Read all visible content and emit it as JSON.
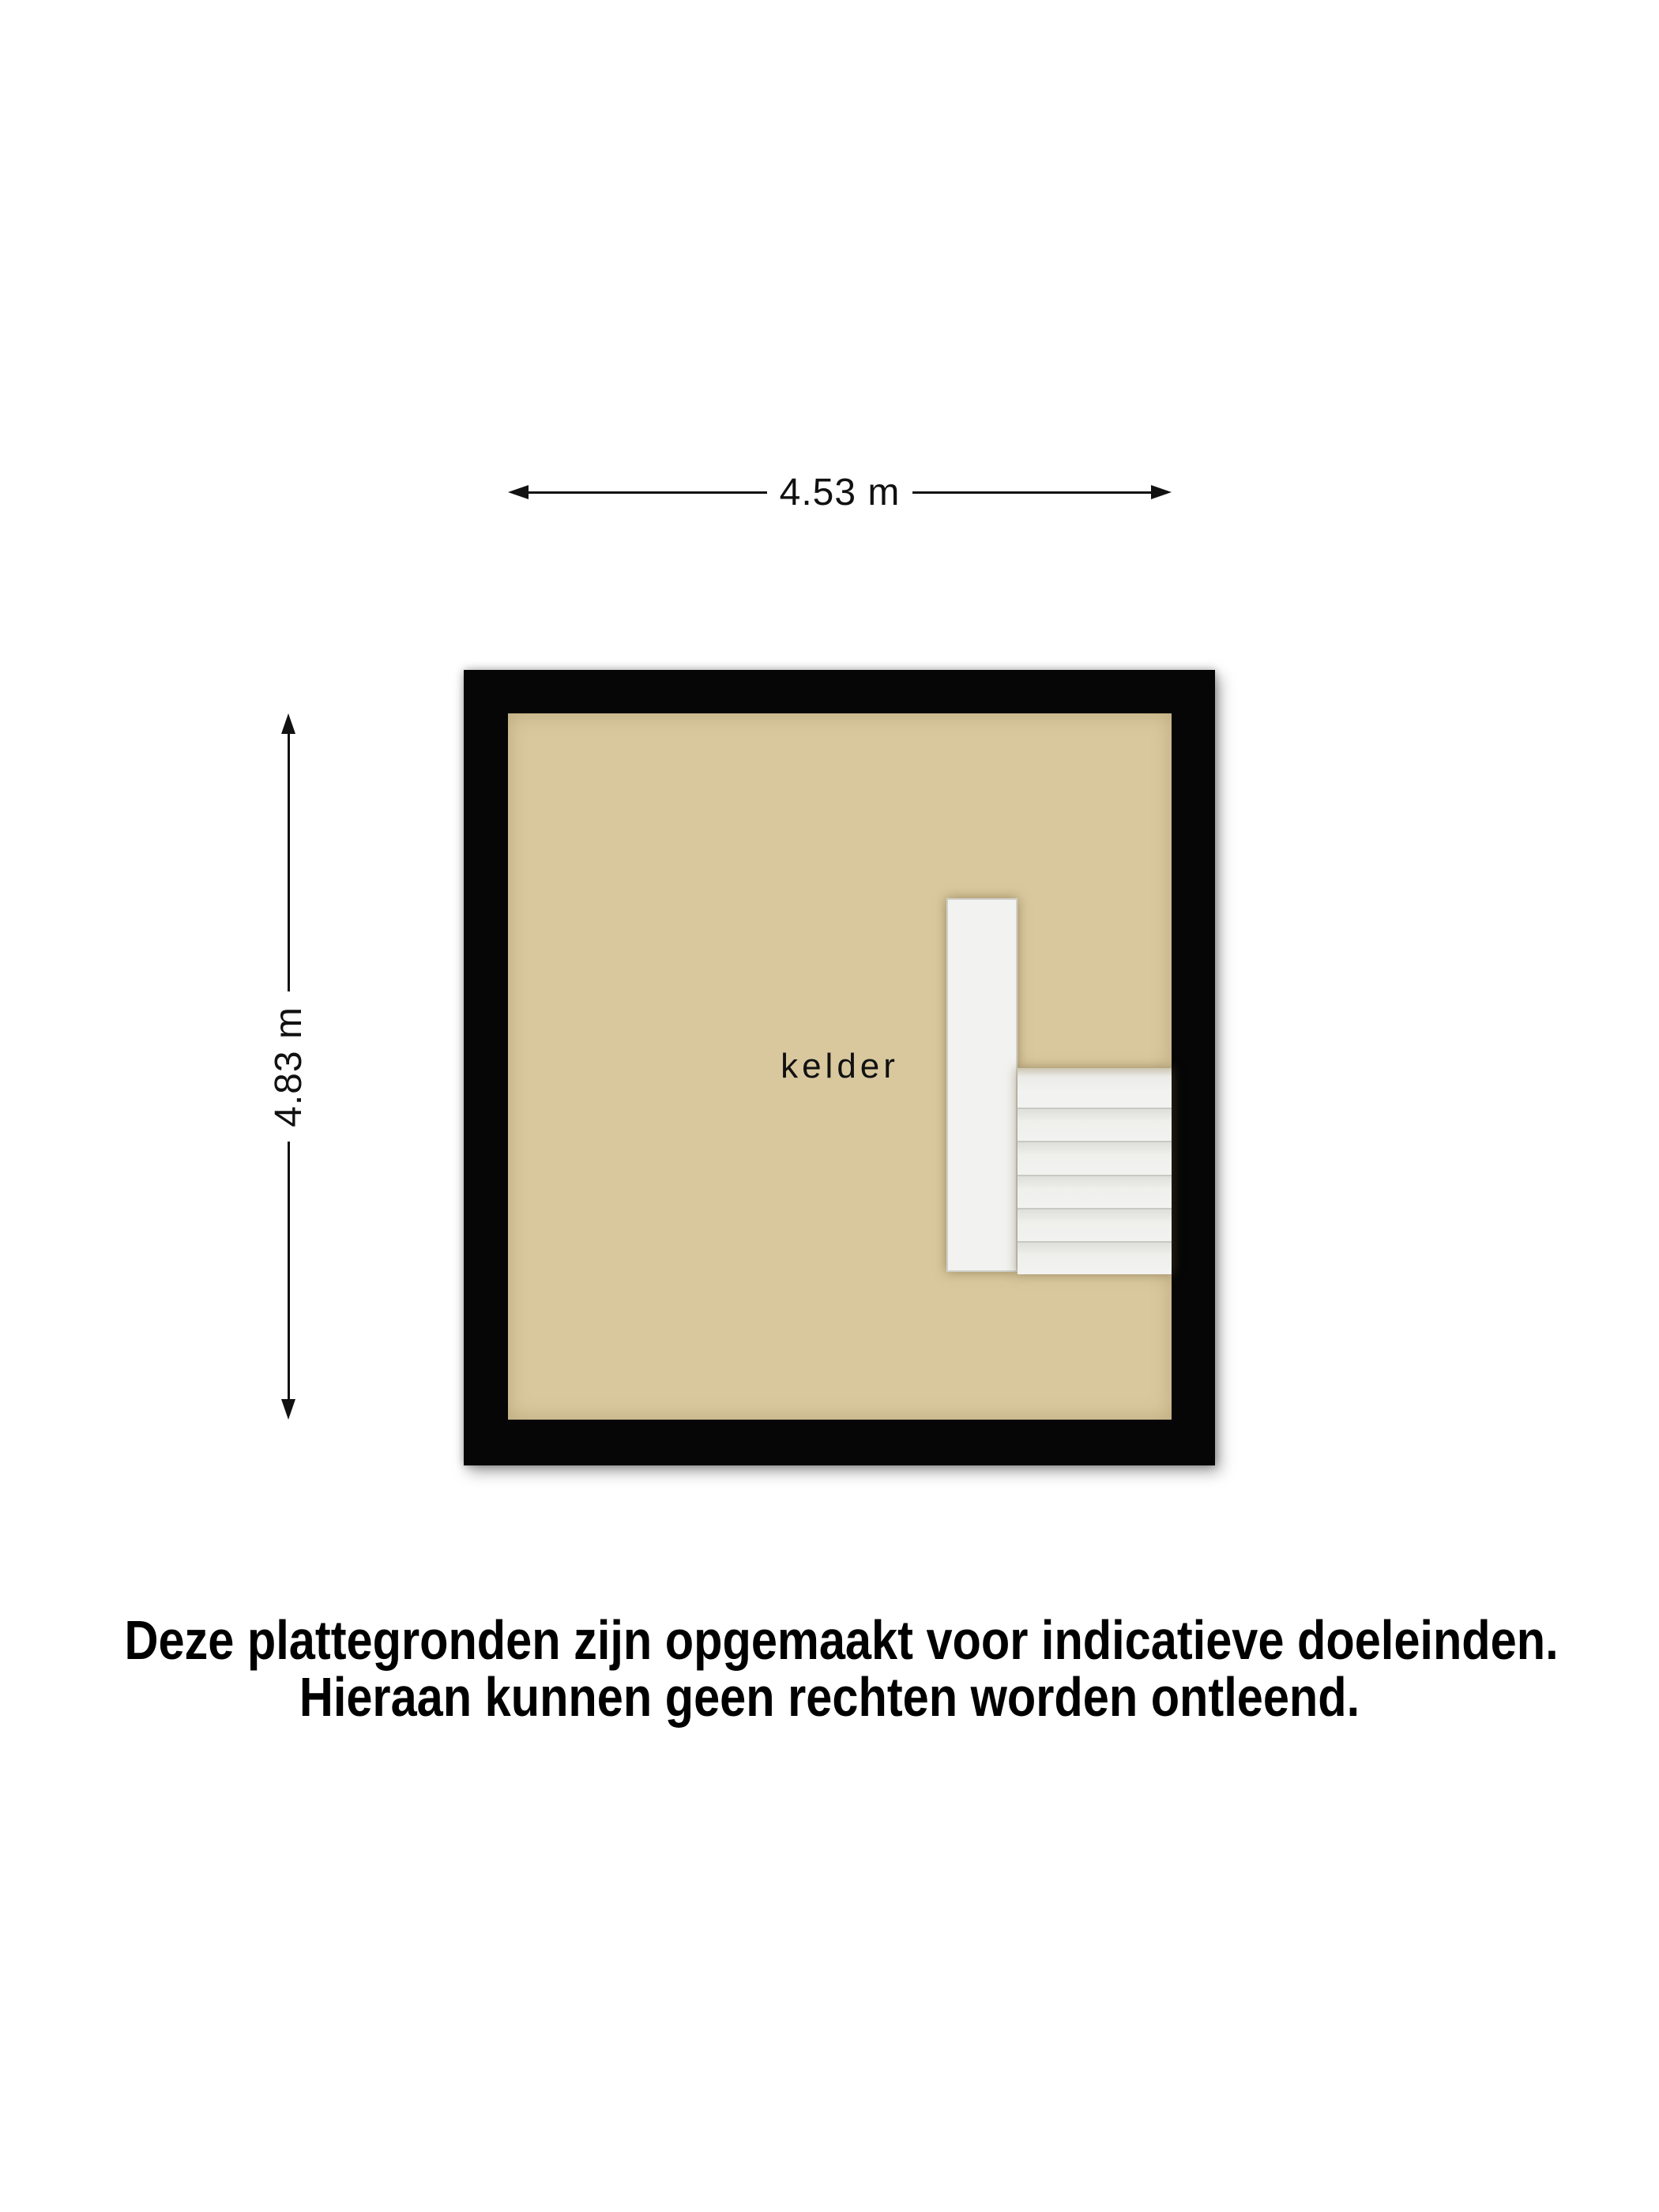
{
  "floor_plan": {
    "room_label": "kelder",
    "width_dimension_label": "4.53 m",
    "height_dimension_label": "4.83 m"
  },
  "disclaimer": {
    "line1": "Deze plattegronden zijn opgemaakt voor indicatieve doeleinden.",
    "line2": "Hieraan kunnen geen rechten worden ontleend."
  },
  "colors": {
    "background": "#ffffff",
    "wall": "#060606",
    "floor": "#d9c89e",
    "stairs": "#f2f2f0",
    "text": "#111111"
  }
}
